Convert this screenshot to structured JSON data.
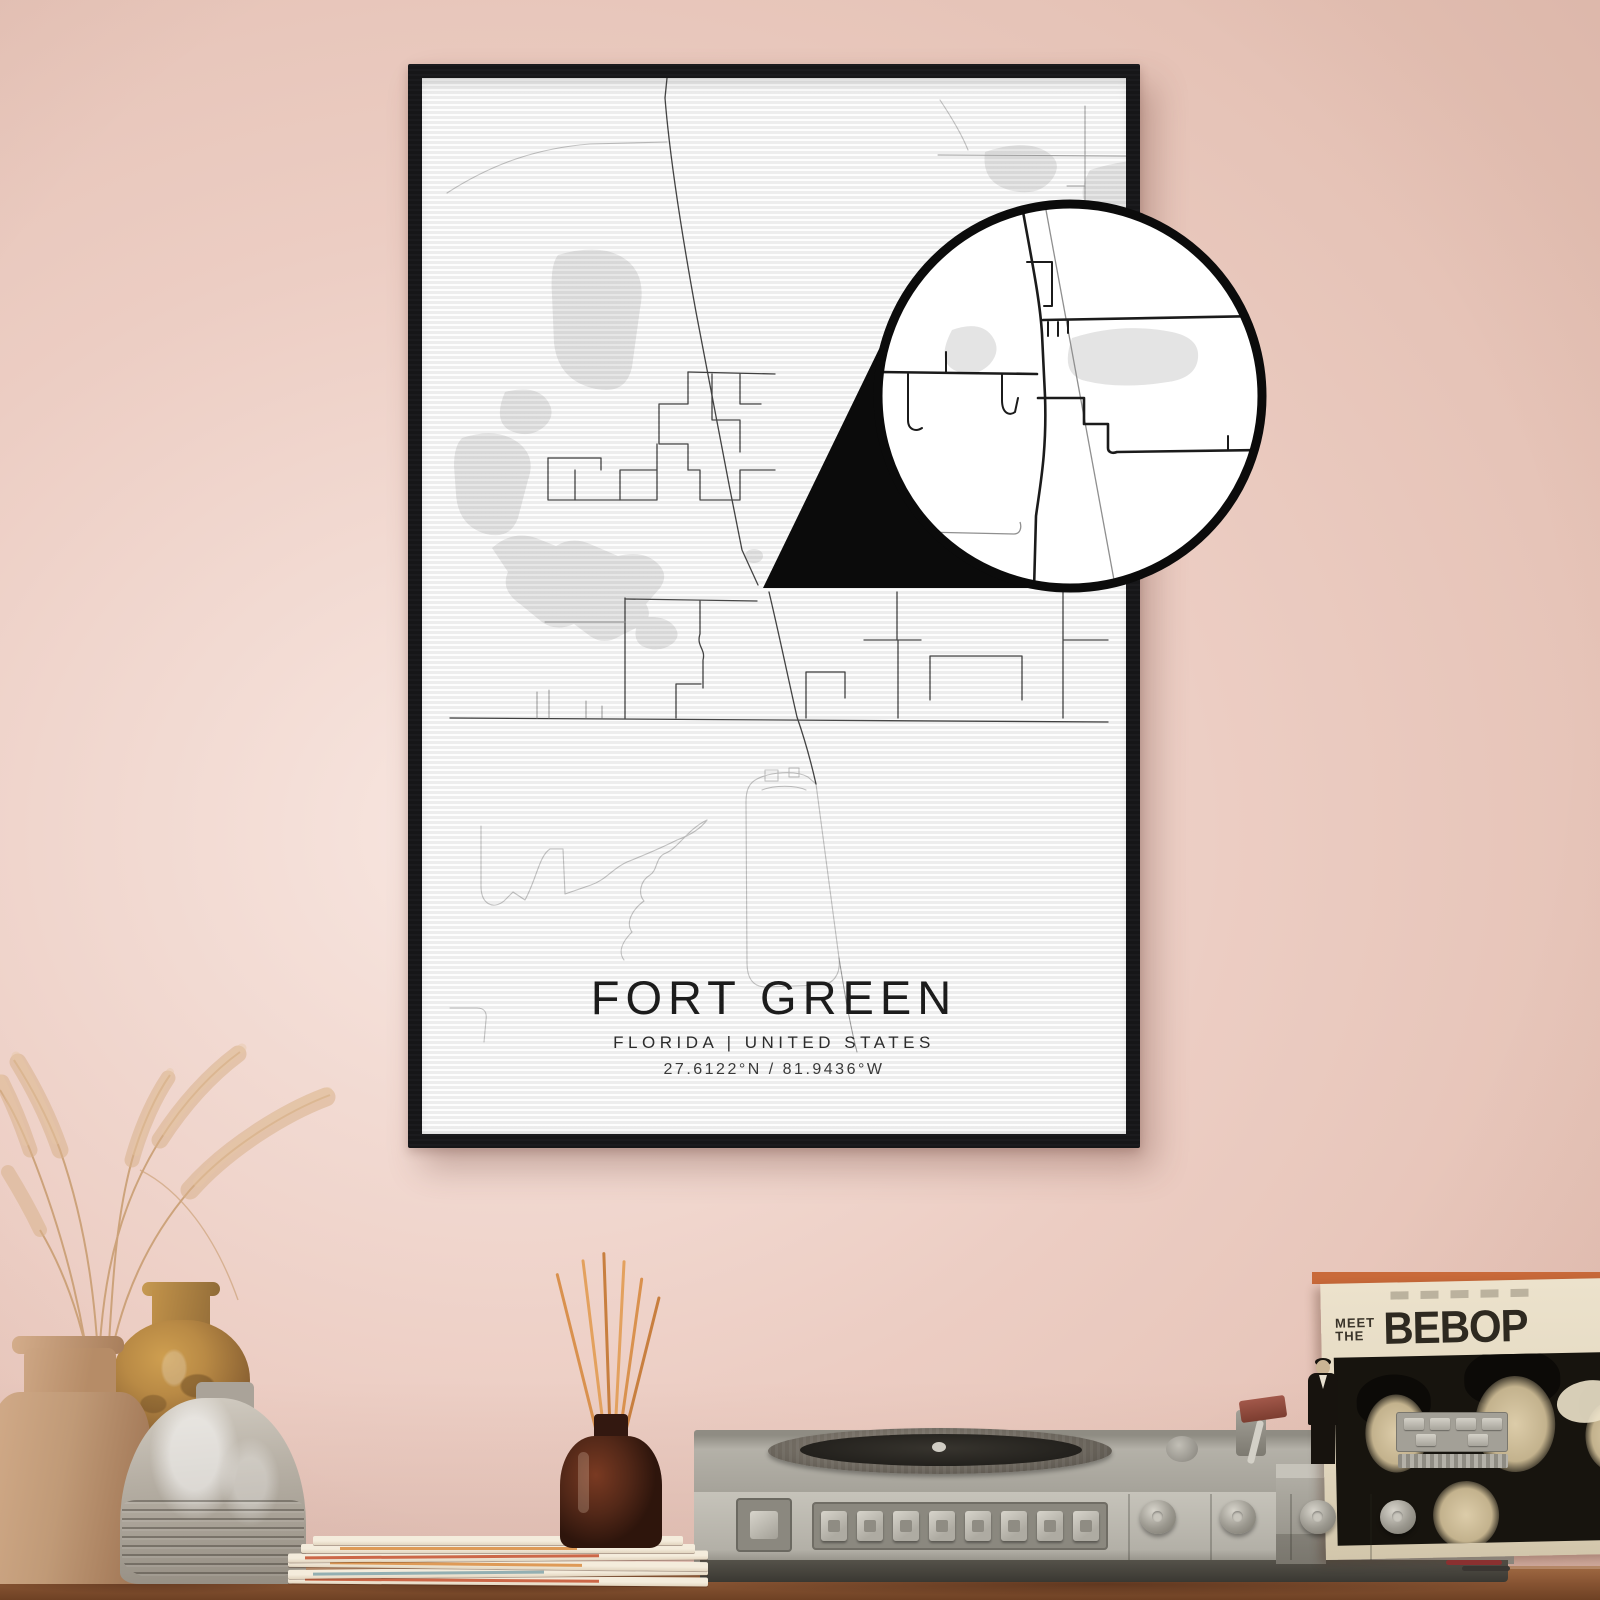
{
  "poster": {
    "title": "FORT GREEN",
    "subtitle": "FLORIDA | UNITED STATES",
    "coordinates": "27.6122°N / 81.9436°W"
  },
  "record_sleeve": {
    "meet": "MEET",
    "the": "THE",
    "band": "BEBOP"
  },
  "colors": {
    "wall": "#eccdc3",
    "wall_light": "#f8e7e1",
    "wall_dark": "#e3bfb2",
    "frame": "#17171a",
    "poster": "#fdfdfd",
    "road": "#444444",
    "road_light": "#c3c3c3",
    "water": "#e6e6e6",
    "callout_ink": "#0b0b0b",
    "table": "#8e5a37",
    "player": "#bcb9b0",
    "sleeve": "#e2d7bf",
    "sleeve_photo": "#17140e",
    "stick": "#d9914e",
    "bottle": "#532818",
    "vase_tan": "#c09a77",
    "vase_mustard": "#b98a45",
    "vase_gray": "#b7b0a5",
    "grass": "#d9b28c",
    "magazine_edge": "#c4502e"
  }
}
